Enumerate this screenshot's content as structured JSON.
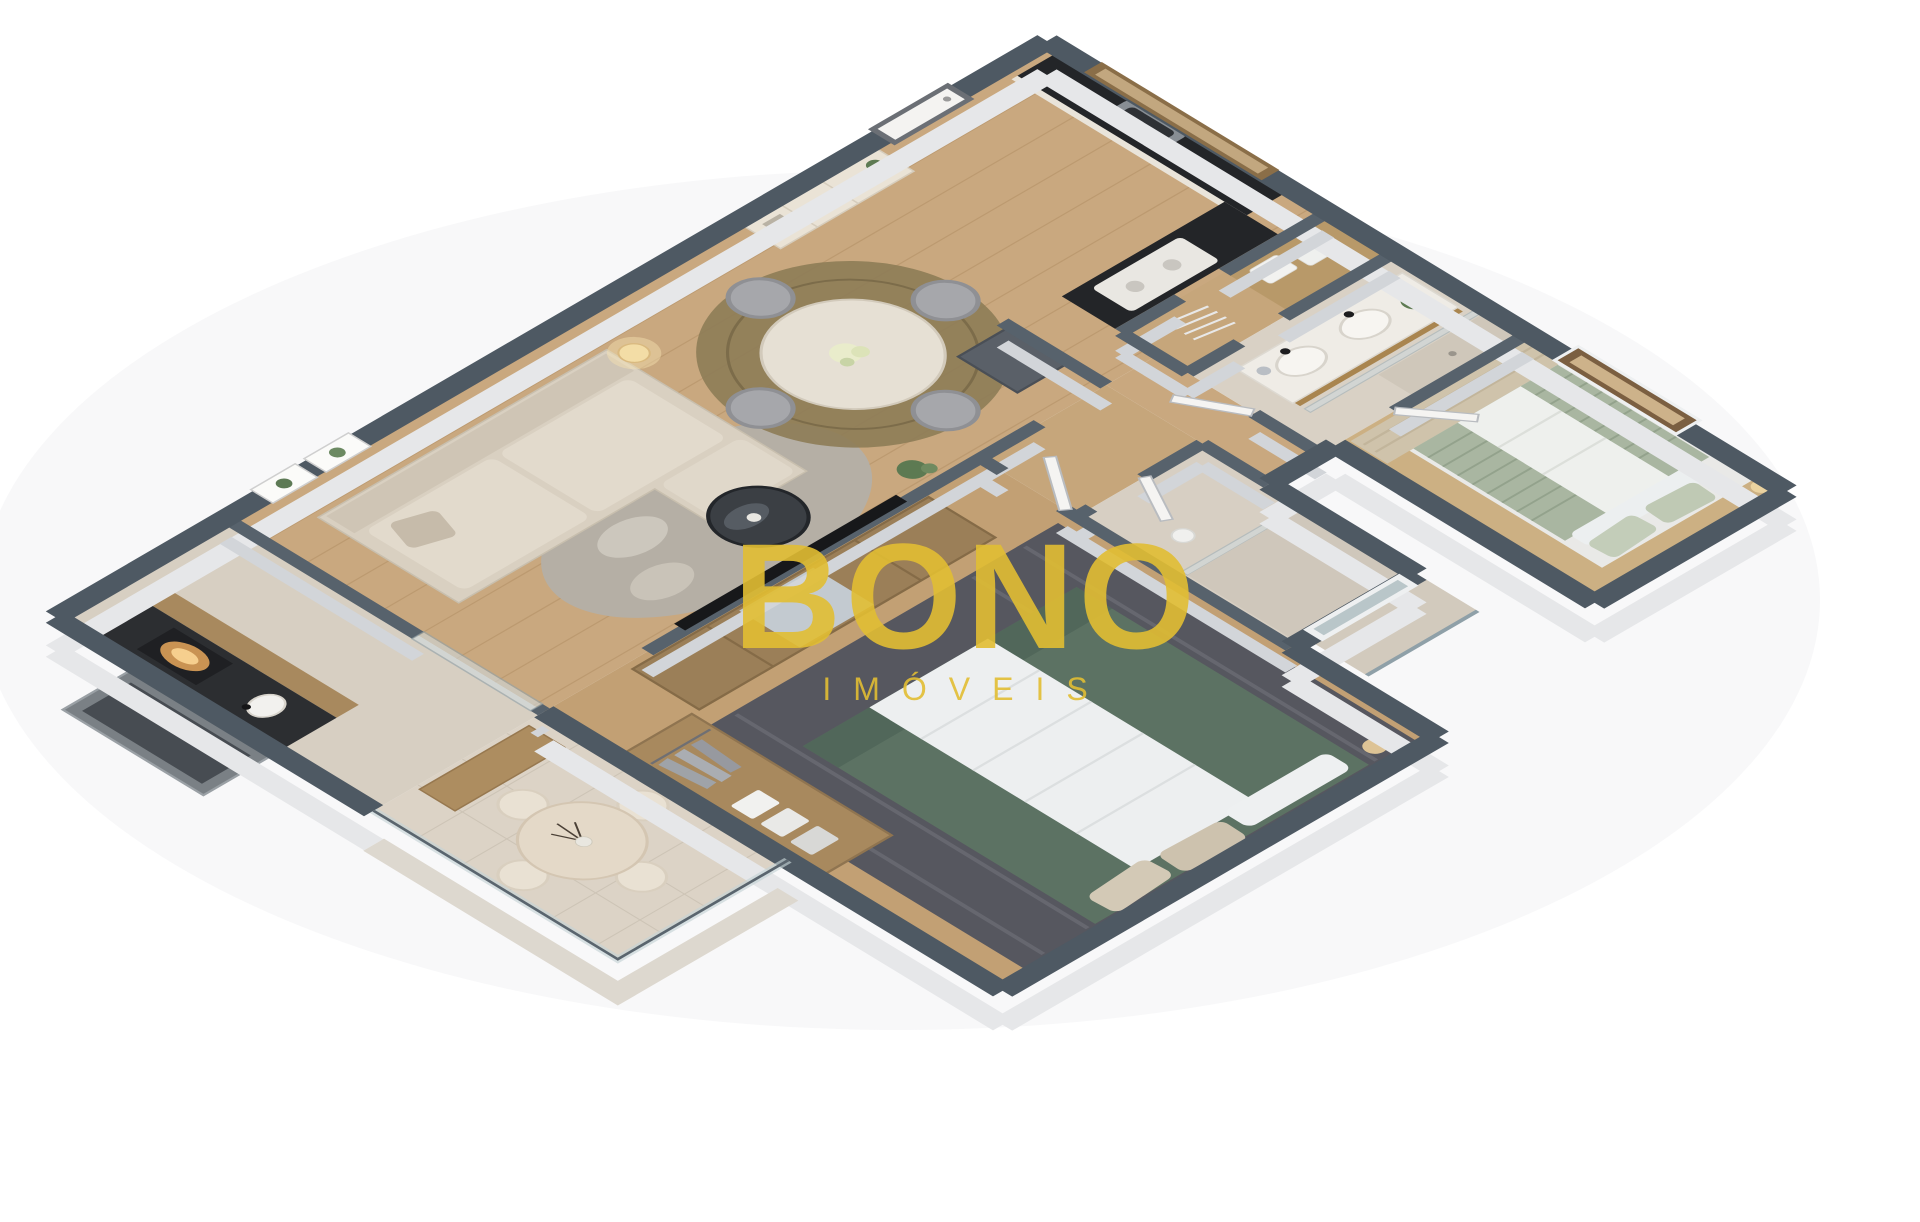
{
  "watermark": {
    "title": "BONO",
    "subtitle": "IMÓVEIS"
  },
  "colors": {
    "brand_yellow": "#E2BE33",
    "background": "#FFFFFF",
    "wall_top_outer": "#4E5963",
    "wall_top_inner": "#57626C",
    "wall_face_outer": "#E6E7E9",
    "wall_face_inner": "#D2D5D9",
    "floor_wood": "#C9A87F",
    "floor_wood_dark": "#C2A074",
    "floor_tile": "#D8D0C4",
    "counter_black": "#232528",
    "sofa_beige": "#D9D0C1",
    "bed_green": "#5C7263",
    "bed_sage": "#A9B6A1",
    "rug_dark": "#56575F",
    "rug_pebble": "#B5AFA5",
    "rug_jute": "#8D7C57",
    "wood_furniture": "#9B7F58",
    "window_bronze": "#7B5F41",
    "plant_green": "#5D7A52"
  }
}
